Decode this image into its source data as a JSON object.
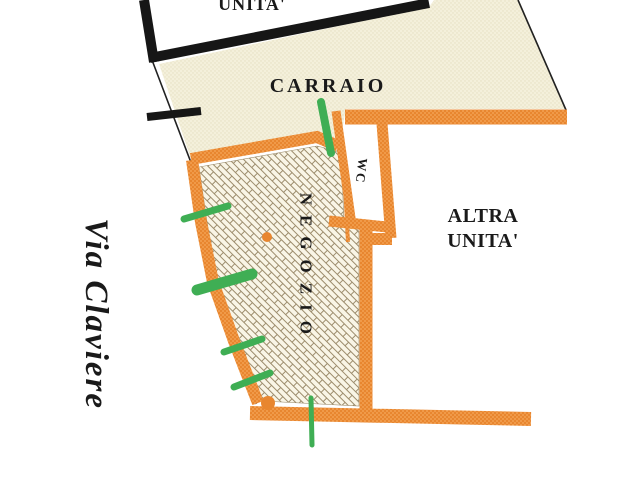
{
  "plan_labels": {
    "adjacent_unit_top": "UNITA'",
    "carraio": "CARRAIO",
    "wc": "WC",
    "negozio": "NEGOZIO",
    "altra_line1": "ALTRA",
    "altra_line2": "UNITA'",
    "street_name": "Via Claviere"
  },
  "colors": {
    "wall_orange": "#E8862F",
    "wall_orange_light": "#F6A95C",
    "wall_black": "#161616",
    "area_beige": "#F4F0DB",
    "area_beige_dot": "#E5DFC1",
    "hatch_bg": "#F9F5E6",
    "hatch_line": "#9C8C6C",
    "marker_green": "#3FAE54",
    "text_black": "#1A1A1A",
    "boundary_line": "#222222"
  }
}
